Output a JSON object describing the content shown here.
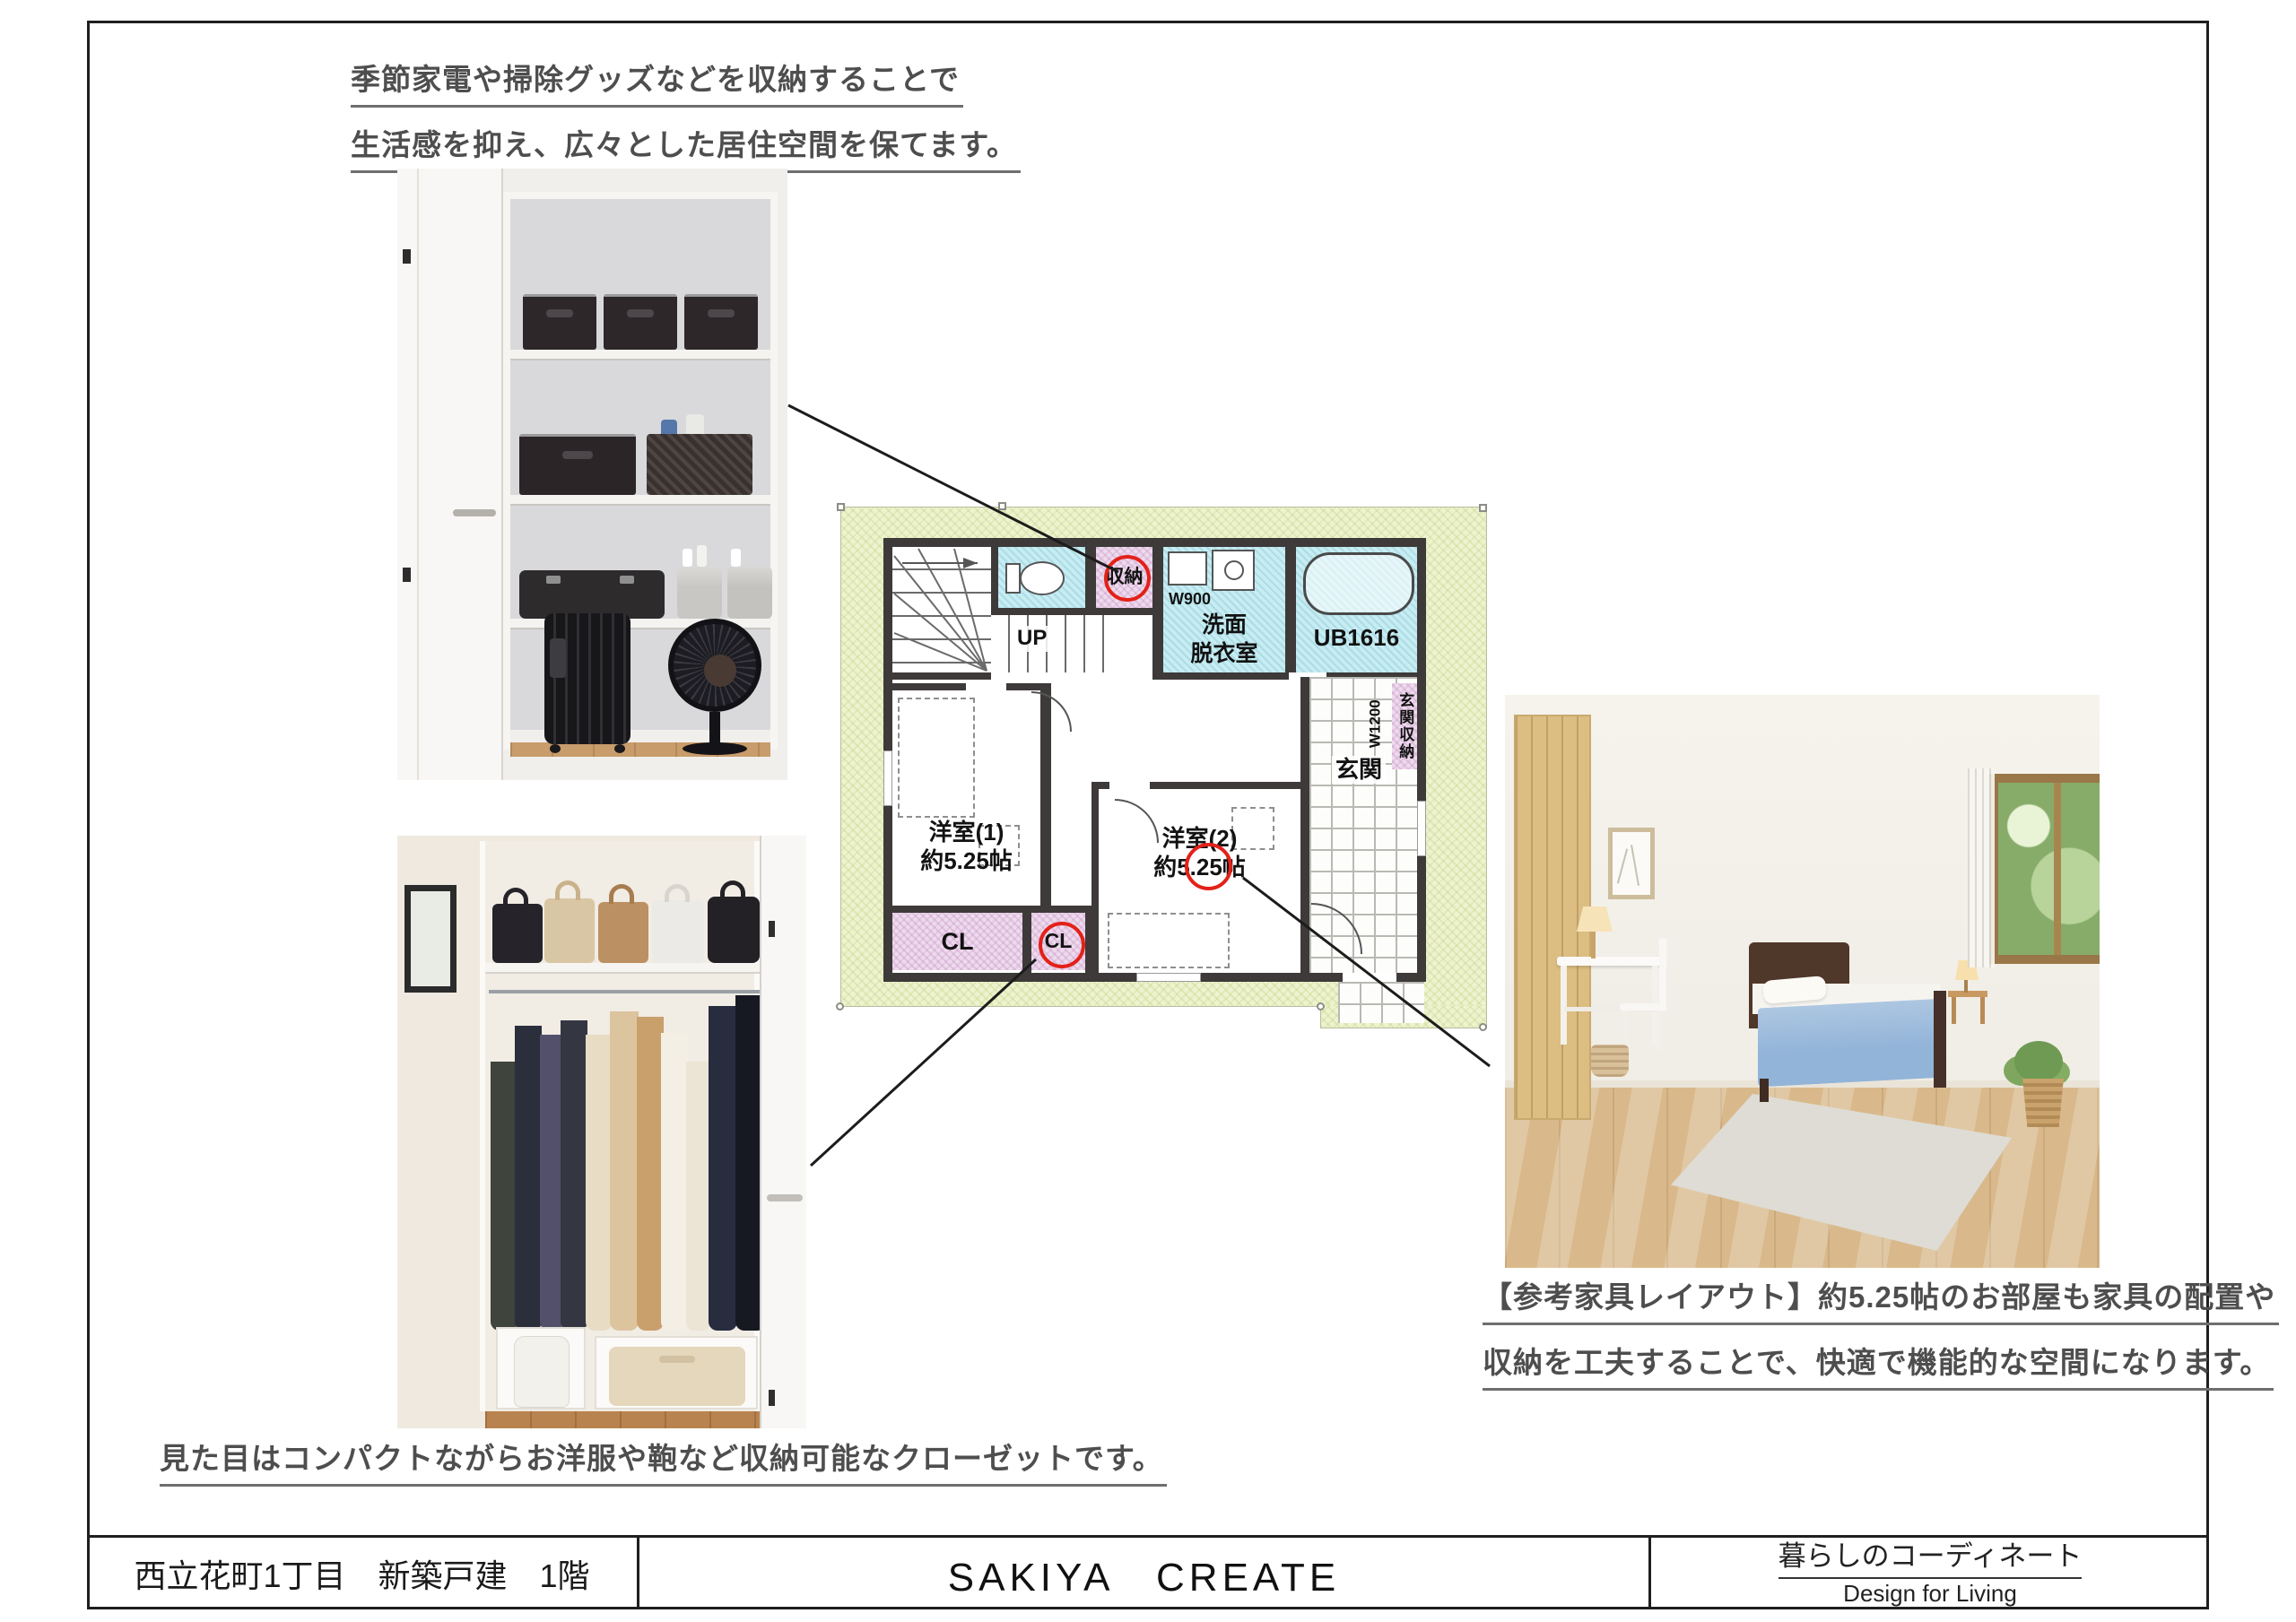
{
  "captions": {
    "top": {
      "line1": "季節家電や掃除グッズなどを収納することで",
      "line2": "生活感を抑え、広々とした居住空間を保てます。"
    },
    "closet": "見た目はコンパクトながらお洋服や鞄など収納可能なクローゼットです。",
    "bedroom": {
      "line1": "【参考家具レイアウト】約5.25帖のお部屋も家具の配置や",
      "line2": "収納を工夫することで、快適で機能的な空間になります。"
    }
  },
  "floor_plan": {
    "labels": {
      "up": "UP",
      "storage": "収納",
      "width_w900": "W900",
      "washroom_line1": "洗面",
      "washroom_line2": "脱衣室",
      "bath_unit": "UB1616",
      "entrance": "玄関",
      "entrance_storage": "玄関収納",
      "width_w1200": "W1200",
      "room1_name": "洋室(1)",
      "room1_size": "約5.25帖",
      "room2_name": "洋室(2)",
      "room2_size": "約5.25帖",
      "closet1": "CL",
      "closet2": "CL"
    }
  },
  "footer": {
    "left": "西立花町1丁目　新築戸建　1階",
    "center": "SAKIYA　CREATE",
    "right_title": "暮らしのコーディネート",
    "right_subtitle": "Design for Living"
  },
  "colors": {
    "accent_red": "#e32119",
    "wall": "#3d3a39",
    "plan_bg": "#eef3cf",
    "wet_area": "#c7ecf2",
    "storage_area": "#eddcec",
    "caption_text": "#4e4e4e",
    "line": "#1c1c1c"
  }
}
